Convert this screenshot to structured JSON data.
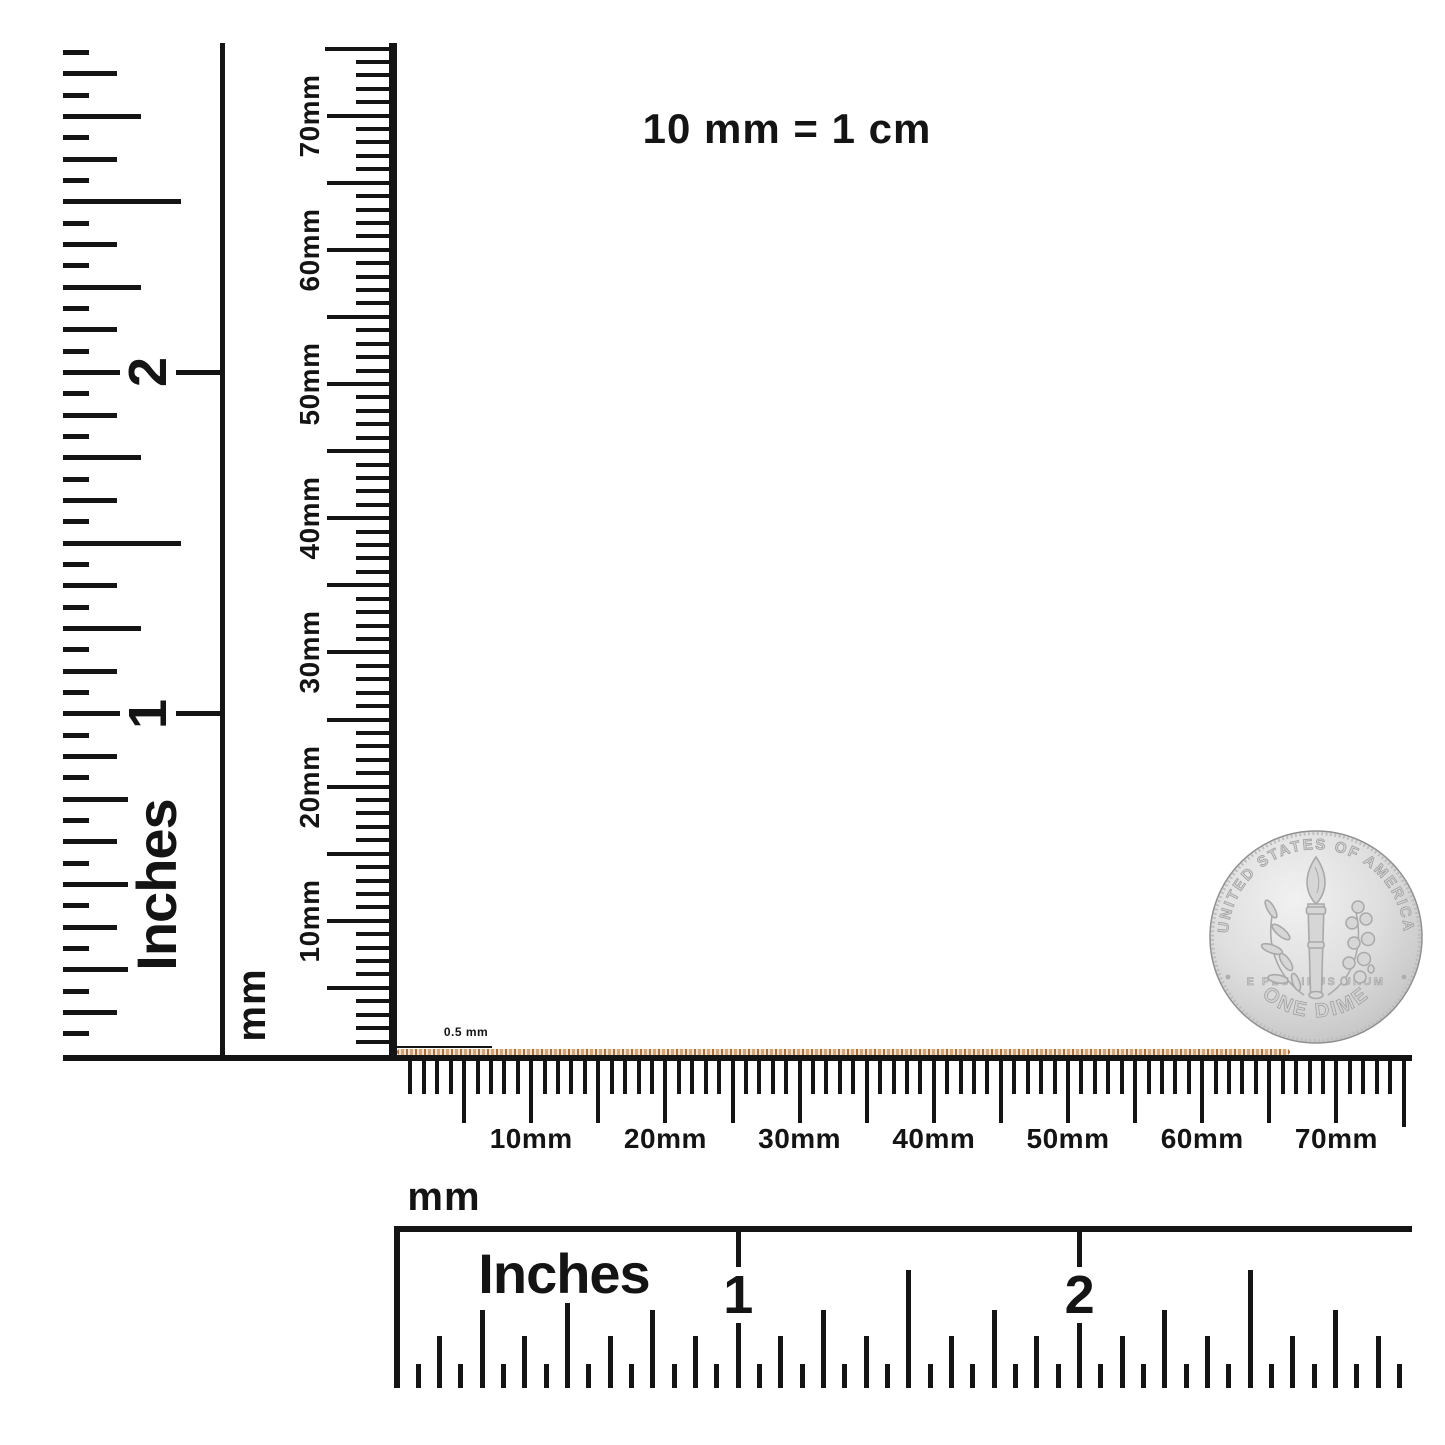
{
  "note": {
    "text": "10 mm = 1 cm"
  },
  "chain": {
    "label": "0.5 mm",
    "color_dark": "#a8713f",
    "color_mid": "#d3a478",
    "color_light": "#f3e3d0"
  },
  "rulers": {
    "mm_tick_labels": [
      "10mm",
      "20mm",
      "30mm",
      "40mm",
      "50mm",
      "60mm",
      "70mm"
    ],
    "inch_tick_labels": [
      "1",
      "2"
    ],
    "left_inches": {
      "title": "Inches"
    },
    "vertical_mm": {
      "unit_label": "mm"
    },
    "horizontal_mm": {
      "unit_label": "mm"
    },
    "bottom_inches": {
      "title": "Inches"
    }
  },
  "coin": {
    "top_text": "UNITED STATES OF AMERICA",
    "bottom_text": "ONE DIME",
    "middle_text": "E PLURIBUS UNUM",
    "base_color": "#d9d9d9",
    "detail_color": "#a9a9a9"
  }
}
